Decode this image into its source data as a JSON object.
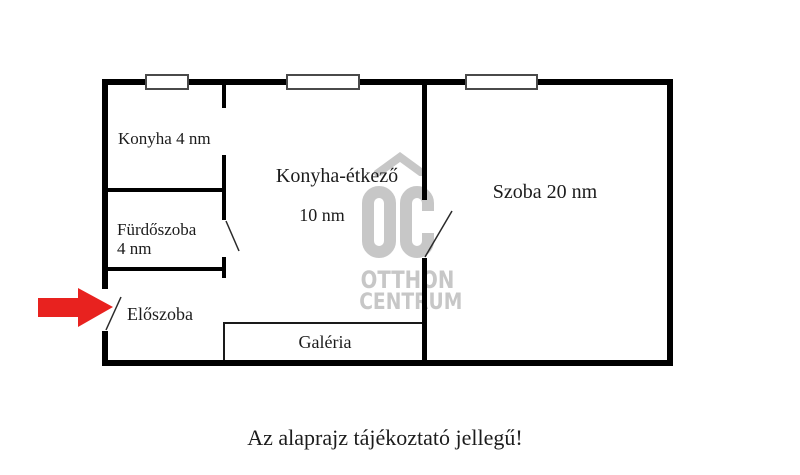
{
  "disclaimer": "Az alaprajz tájékoztató jellegű!",
  "rooms": {
    "konyha": {
      "label": "Konyha 4 nm"
    },
    "furdoszoba": {
      "line1": "Fürdőszoba",
      "line2": "4 nm"
    },
    "eloszoba": {
      "label": "Előszoba"
    },
    "konyha_etkezo": {
      "label": "Konyha-étkező",
      "area": "10 nm"
    },
    "szoba": {
      "label": "Szoba 20 nm"
    },
    "galeria": {
      "label": "Galéria"
    }
  },
  "watermark": {
    "monogram": "OC",
    "brand_line1": "OTTHON",
    "brand_line2": "CENTRUM"
  },
  "icons": {
    "entrance_arrow": "red-arrow-right-icon",
    "logo": "otthon-centrum-house-logo"
  },
  "colors": {
    "wall": "#000000",
    "arrow_red": "#e8221f",
    "watermark_gray": "#c7c7c7",
    "text": "#1c1c1c"
  }
}
